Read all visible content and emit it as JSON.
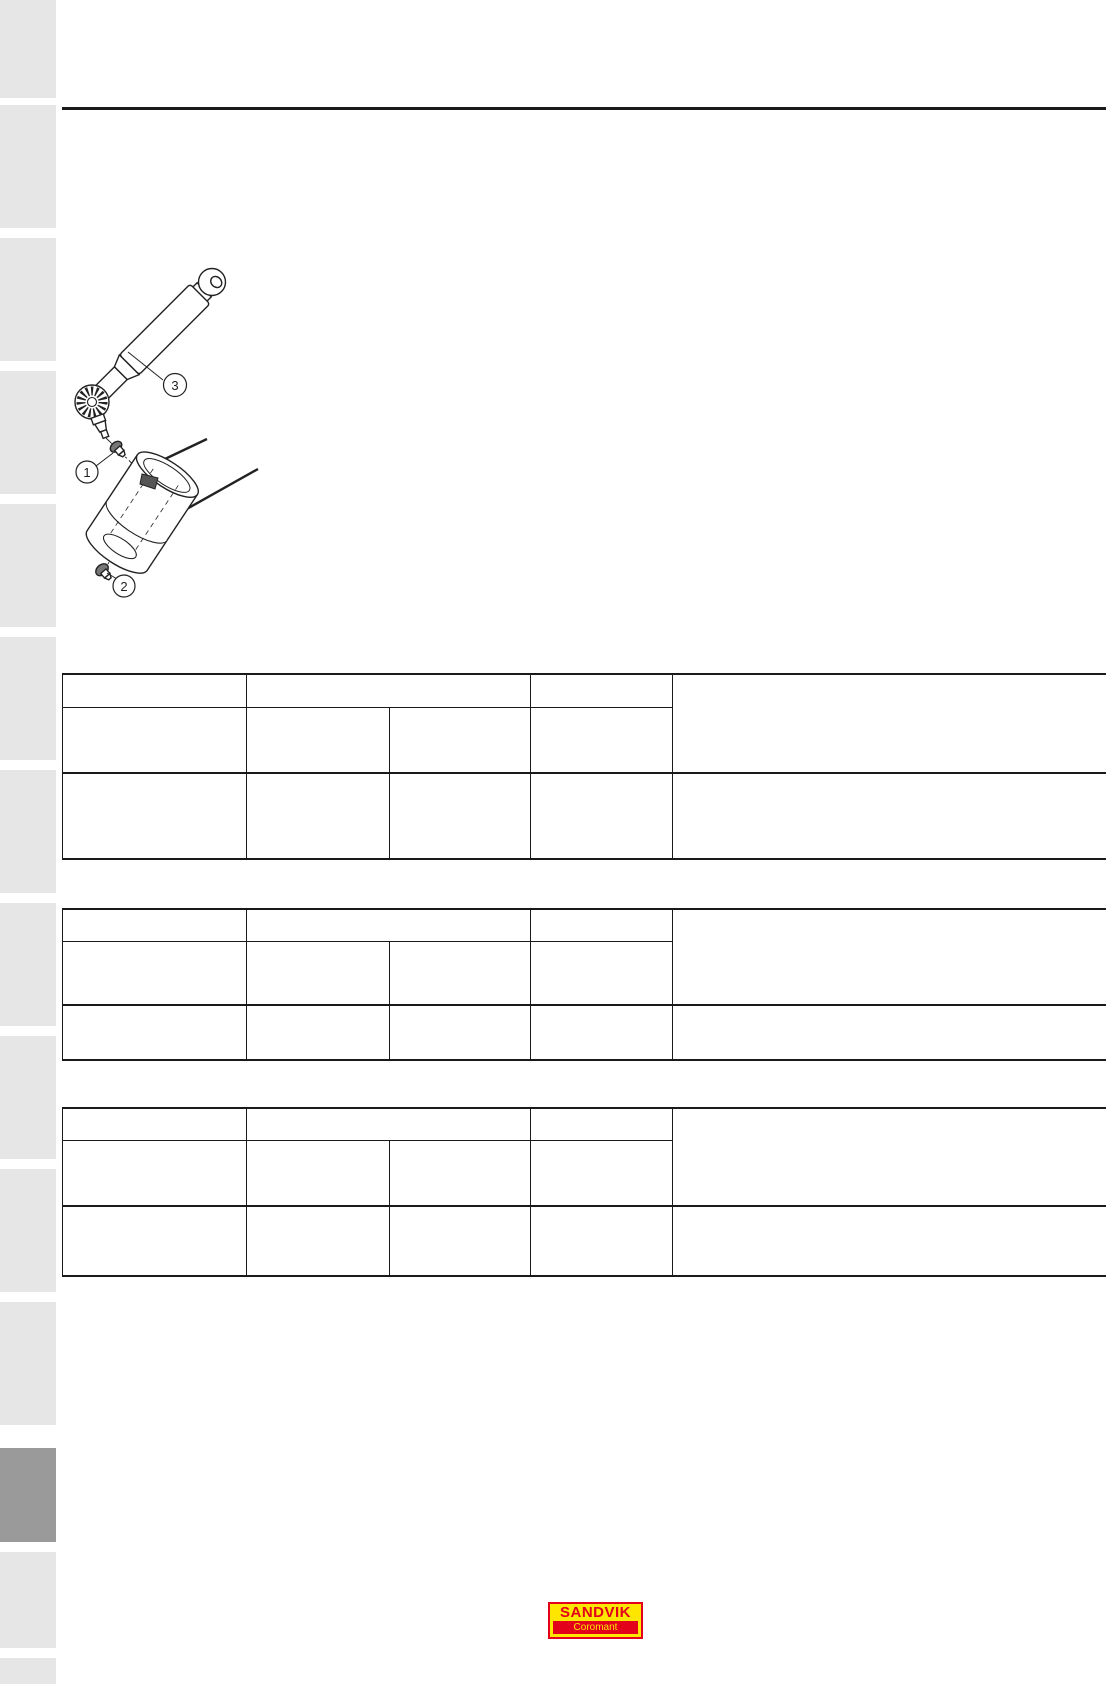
{
  "figure": {
    "callouts": [
      "1",
      "2",
      "3"
    ]
  },
  "logo": {
    "name": "SANDVIK",
    "division": "Coromant",
    "red": "#e2001a",
    "yellow": "#ffe600"
  },
  "colors": {
    "sidebar_light": "#e6e6e6",
    "sidebar_dark": "#9a9a9a",
    "rule": "#1a1a1a"
  },
  "tables": {
    "count": 3
  }
}
